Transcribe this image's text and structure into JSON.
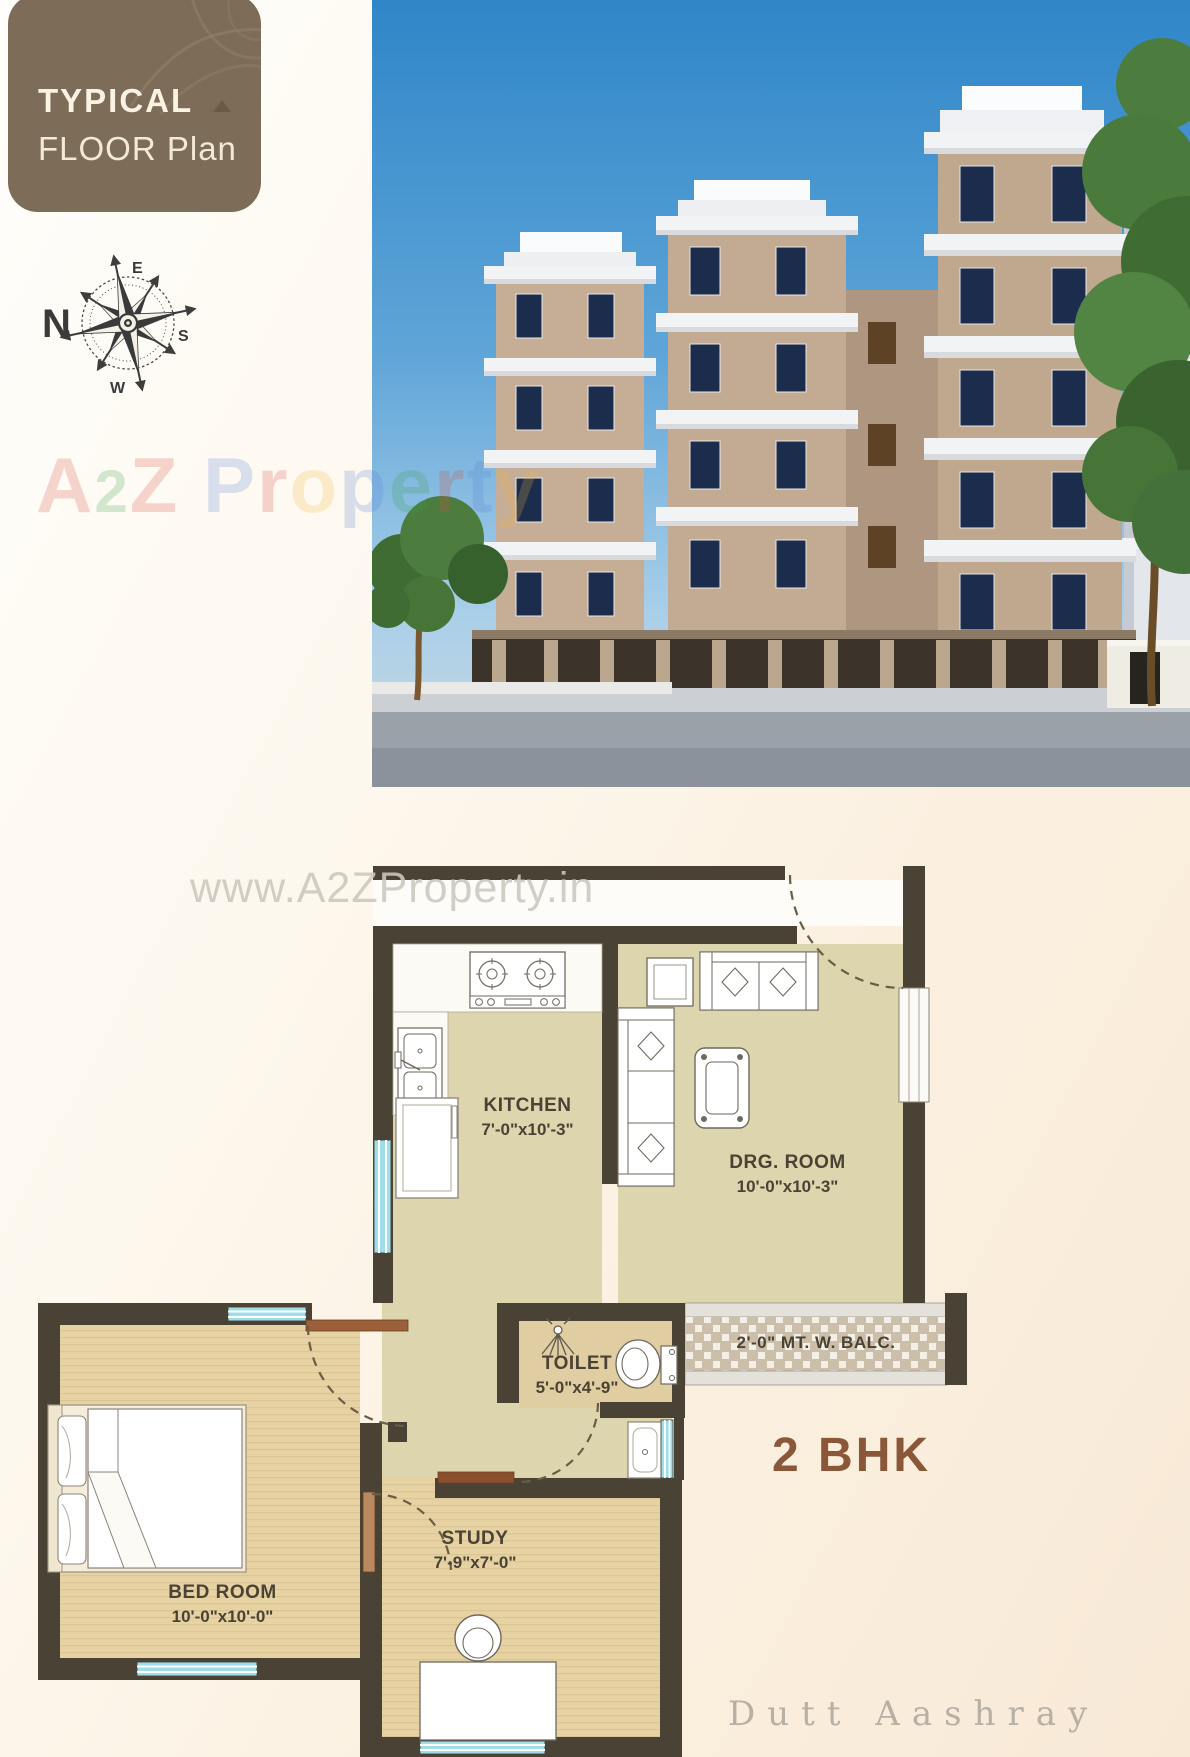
{
  "badge": {
    "line1": "TYPICAL",
    "line2": "FLOOR Plan"
  },
  "compass": {
    "north": "N",
    "east": "E",
    "south": "S",
    "west": "W"
  },
  "watermark": {
    "a": "A",
    "two": "2",
    "z": "Z",
    "property_letters": [
      "P",
      "r",
      "o",
      "p",
      "e",
      "r",
      "t",
      "y"
    ],
    "url": "www.A2ZProperty.in"
  },
  "plan": {
    "unit_type": "2 BHK",
    "brand": "Dutt Aashray",
    "rooms": {
      "kitchen": {
        "name": "KITCHEN",
        "dims": "7'-0\"x10'-3\""
      },
      "drawing": {
        "name": "DRG. ROOM",
        "dims": "10'-0\"x10'-3\""
      },
      "toilet": {
        "name": "TOILET",
        "dims": "5'-0\"x4'-9\""
      },
      "bedroom": {
        "name": "BED ROOM",
        "dims": "10'-0\"x10'-0\""
      },
      "study": {
        "name": "STUDY",
        "dims": "7'-9\"x7'-0\""
      },
      "balcony": {
        "name": "2'-0\" MT. W. BALC."
      }
    }
  },
  "colors": {
    "badge_brown": "#7d6c57",
    "wall_dark": "#4a4234",
    "floor_beige": "#ddd5ad",
    "floor_tan": "#e6d2a2",
    "window_cyan": "#9fdde9",
    "accent_brown": "#8a5738",
    "sky_blue": "#3e8ecb",
    "door_brown": "#9b5f3a"
  }
}
